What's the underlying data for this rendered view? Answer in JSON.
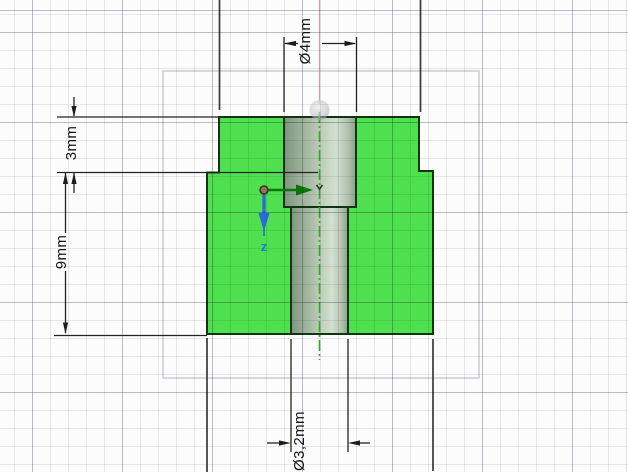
{
  "view": {
    "name": "CAD sketch section view",
    "grid": {
      "minor_px": 18,
      "major_px": 90
    }
  },
  "annotations": {
    "dim_flange_height": {
      "label": "3mm"
    },
    "dim_body_height": {
      "label": "9mm"
    },
    "dim_counterbore_dia": {
      "label": "Ø4mm"
    },
    "dim_hole_dia": {
      "label": "Ø3,2mm"
    }
  },
  "triad": {
    "z_axis_label": "z"
  },
  "colors": {
    "section_fill": "#4ee04e",
    "part_outline": "#123415",
    "centerline": "#2faa2f",
    "dimension": "#232323",
    "axis_x": "#067806",
    "axis_z": "#1f6fd8",
    "bbox": "#c5c8ce"
  }
}
